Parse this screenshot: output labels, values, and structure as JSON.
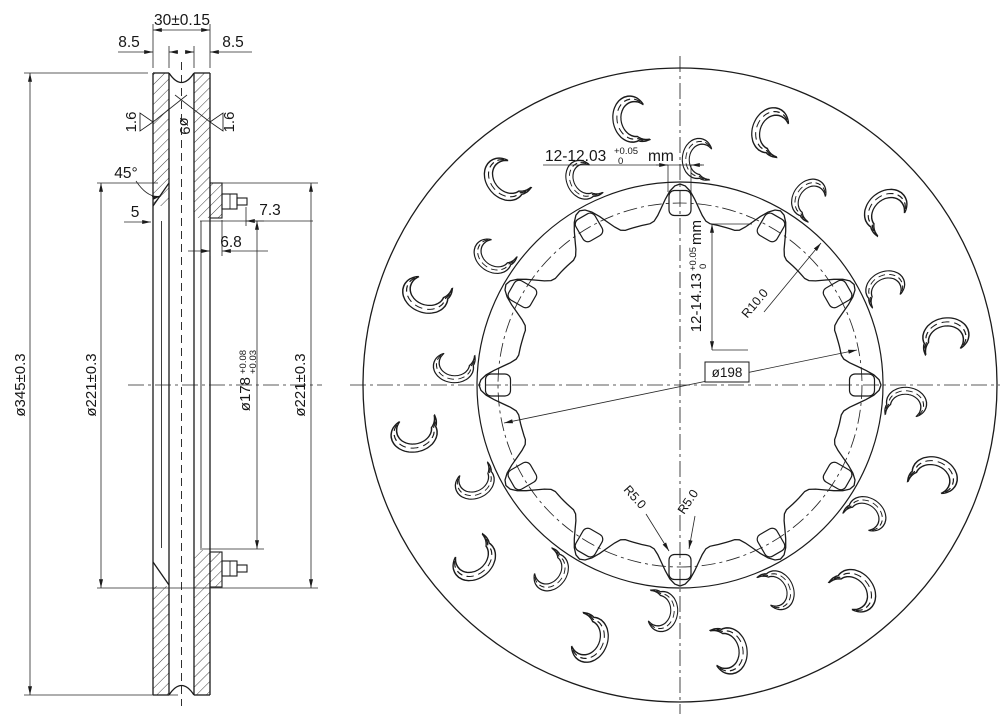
{
  "drawing": {
    "section": {
      "overall_width": "30±0.15",
      "plate_thickness_left": "8.5",
      "plate_thickness_right": "8.5",
      "surface_roughness_left": "1.6",
      "surface_roughness_right": "1.6",
      "vane_pin_dia": "ø9",
      "chamfer_angle": "45°",
      "offset": "5",
      "stud_length": "7.3",
      "flange_thickness": "6.8",
      "outer_dia": "ø345±0.3",
      "friction_inner_dia_left": "ø221±0.3",
      "bore_dia": "ø178",
      "bore_tol_upper": "+0.08",
      "bore_tol_lower": "+0.03",
      "friction_inner_dia_right": "ø221±0.3"
    },
    "front": {
      "drive_hole_width": "12-12.03",
      "drive_hole_width_tol_upper": "+0.05",
      "drive_hole_width_tol_lower": "0",
      "drive_hole_width_unit": "mm",
      "drive_hole_height": "12-14.13",
      "drive_hole_height_tol_upper": "+0.05",
      "drive_hole_height_tol_lower": "0",
      "drive_hole_height_unit": "mm",
      "lobe_radius": "R10.0",
      "bolt_circle_dia": "ø198",
      "valley_radius": "R5.0",
      "corner_radius": "R5.0"
    },
    "geometry": {
      "drive_hole_count": 12,
      "slot_count": 24,
      "line_color": "#1b1b1b",
      "background": "#ffffff"
    }
  }
}
